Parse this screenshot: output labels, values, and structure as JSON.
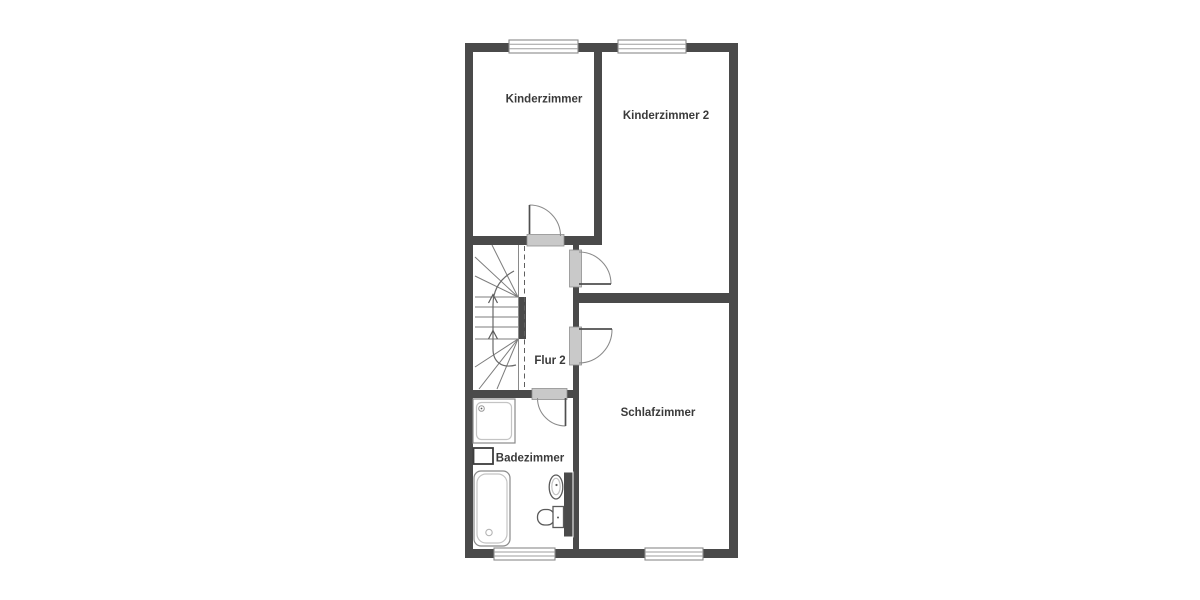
{
  "floorplan": {
    "colors": {
      "background": "#ffffff",
      "wall": "#4a4a4a",
      "threshold-fill": "#c9c9c9",
      "threshold-stroke": "#8f8f8f",
      "label": "#3a3a3a"
    },
    "rooms": [
      {
        "id": "kinderzimmer",
        "label": "Kinderzimmer"
      },
      {
        "id": "kinderzimmer-2",
        "label": "Kinderzimmer 2"
      },
      {
        "id": "flur-2",
        "label": "Flur 2"
      },
      {
        "id": "schlafzimmer",
        "label": "Schlafzimmer"
      },
      {
        "id": "badezimmer",
        "label": "Badezimmer"
      }
    ],
    "fixtures": [
      "staircase",
      "shower",
      "washing-machine",
      "bathtub",
      "washbasin",
      "toilet"
    ],
    "window_count": 4,
    "door_count": 4
  }
}
